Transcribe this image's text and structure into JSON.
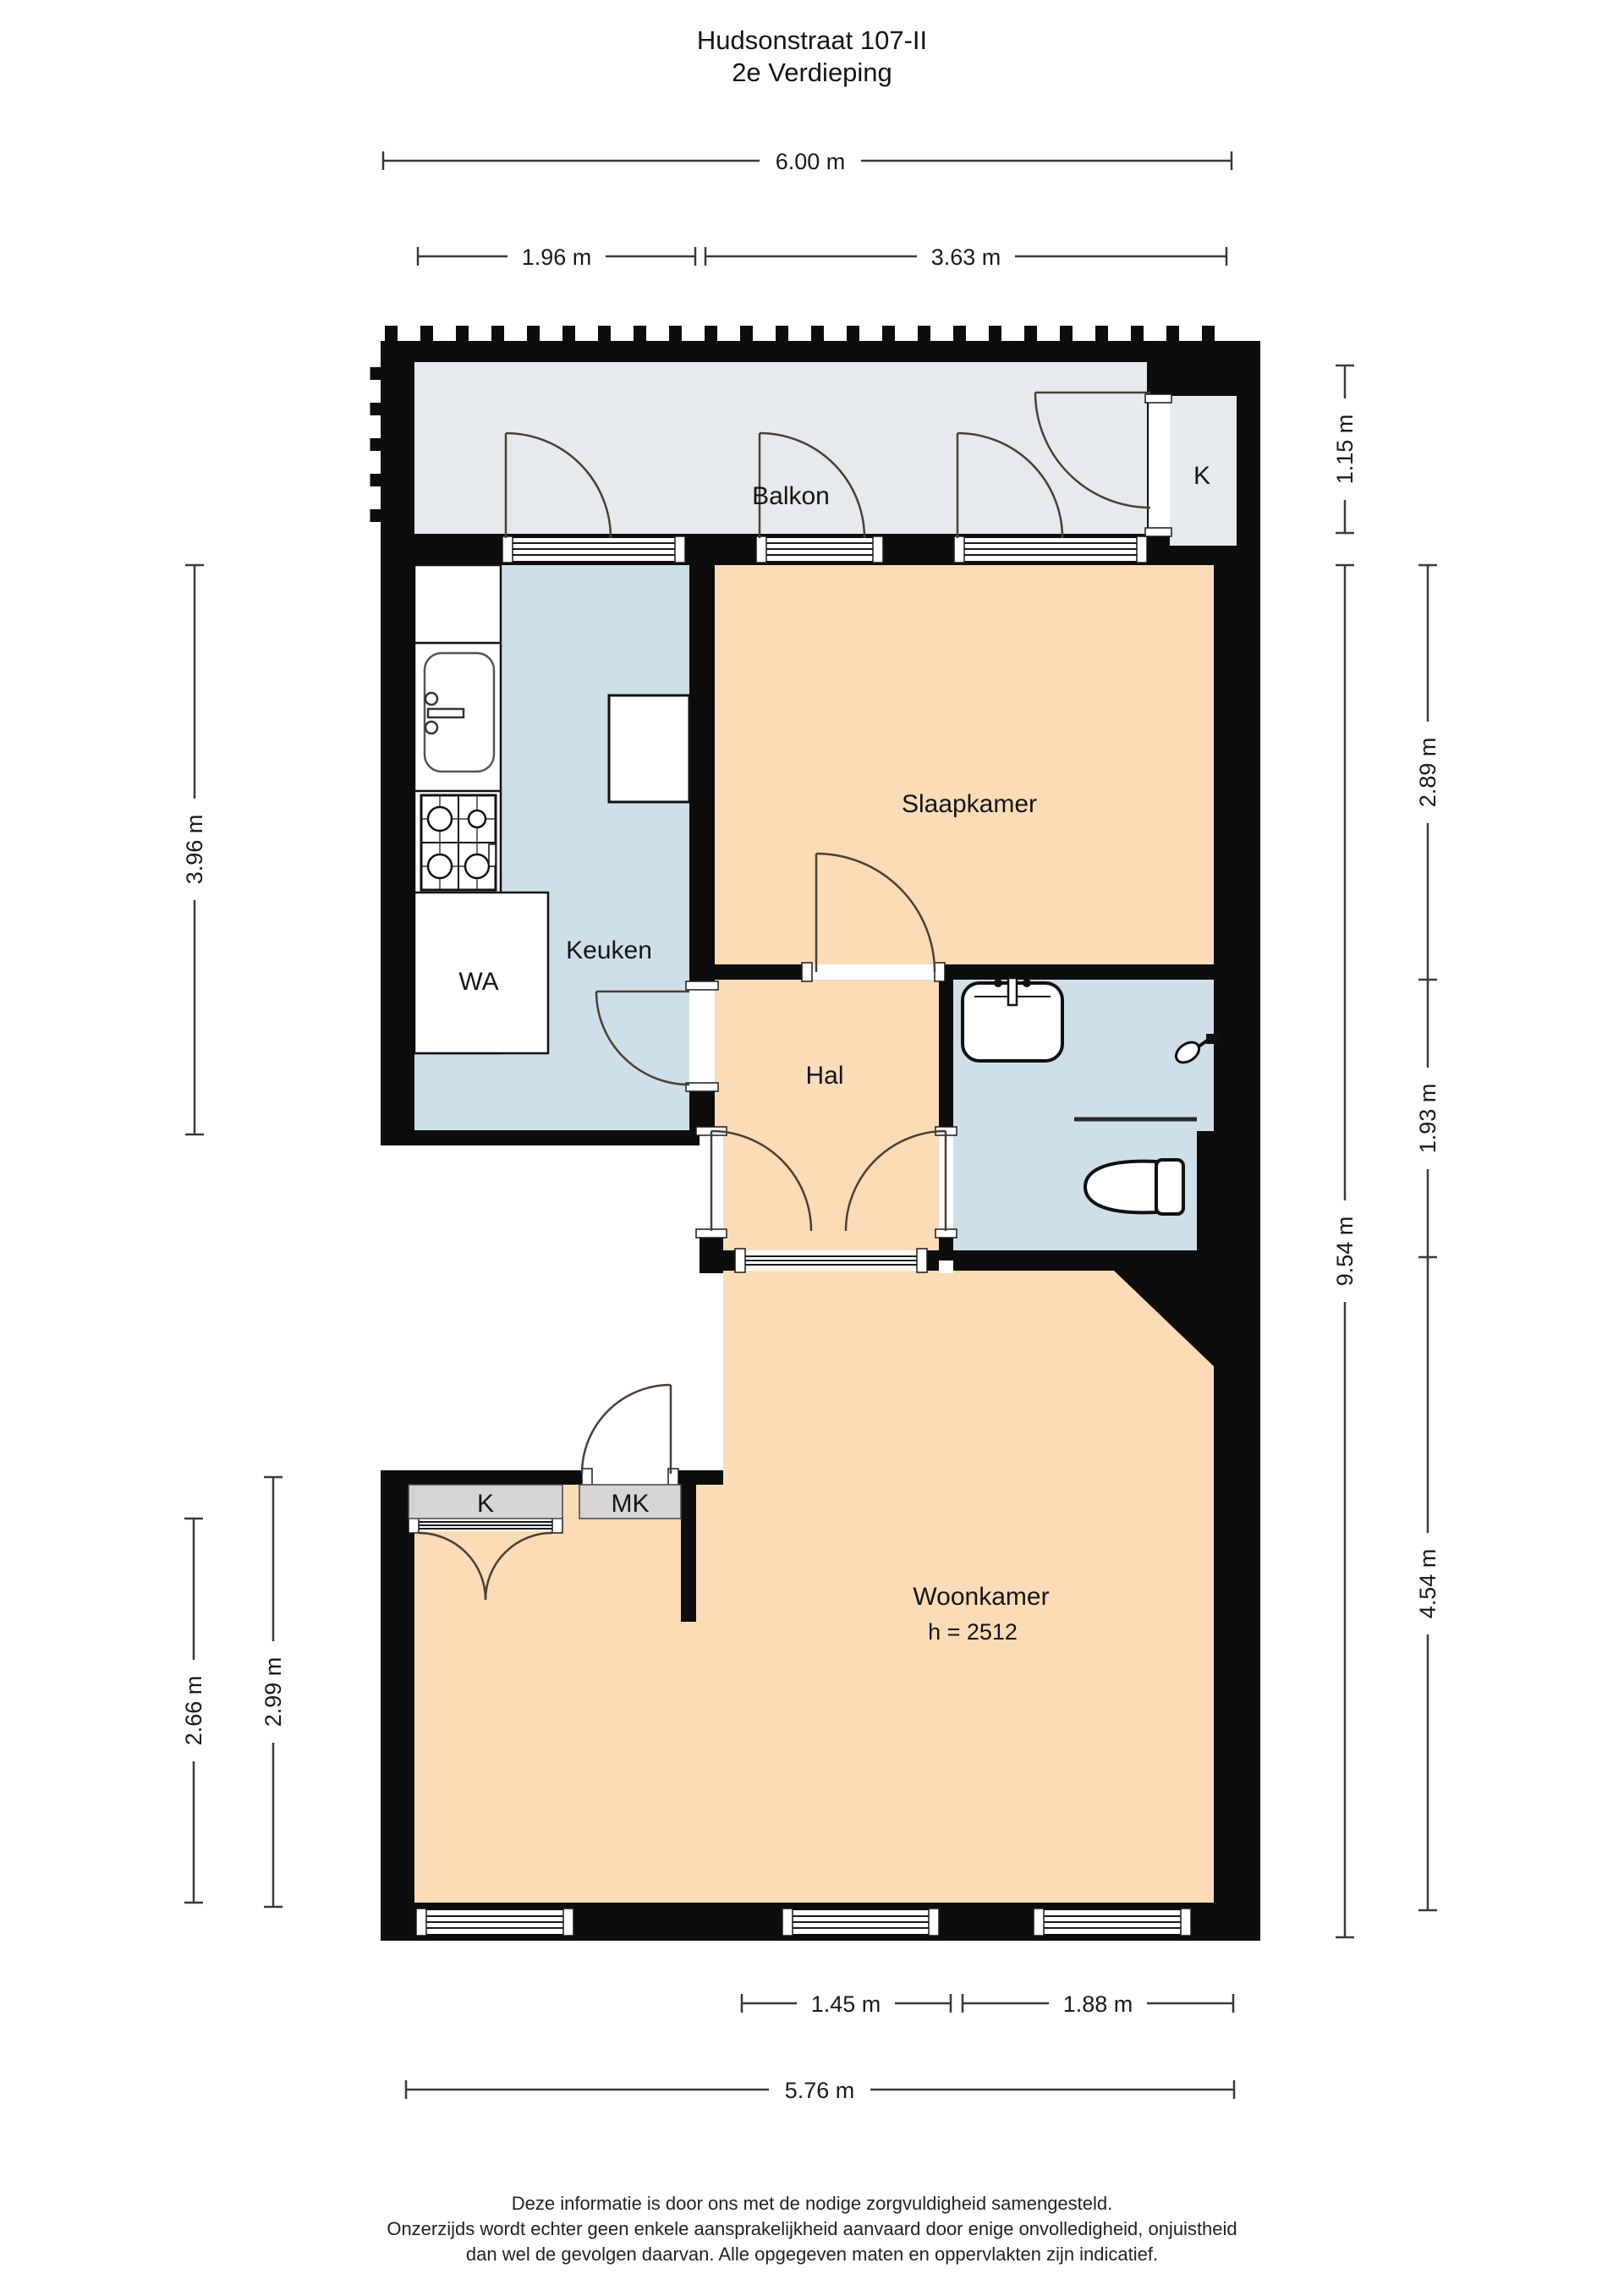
{
  "page": {
    "title_line1": "Hudsonstraat 107-II",
    "title_line2": "2e Verdieping"
  },
  "rooms": {
    "balkon": "Balkon",
    "closet_top": "K",
    "slaapkamer": "Slaapkamer",
    "keuken": "Keuken",
    "washer": "WA",
    "hal": "Hal",
    "closet_left": "K",
    "meter_closet": "MK",
    "woonkamer": "Woonkamer",
    "woonkamer_ceiling": "h = 2512"
  },
  "dimensions": {
    "top_total": "6.00 m",
    "top_left": "1.96 m",
    "top_right": "3.63 m",
    "left_kitchen": "3.96 m",
    "left_outer": "2.66 m",
    "left_inner": "2.99 m",
    "right_balcony": "1.15 m",
    "right_total": "9.54 m",
    "right_bedroom": "2.89 m",
    "right_bathroom": "1.93 m",
    "right_living": "4.54 m",
    "bottom_left": "1.45 m",
    "bottom_right": "1.88 m",
    "bottom_total": "5.76 m"
  },
  "footer": {
    "line1": "Deze informatie is door ons met de nodige zorgvuldigheid samengesteld.",
    "line2": "Onzerzijds wordt echter geen enkele aansprakelijkheid aanvaard door enige onvolledigheid, onjuistheid",
    "line3": "dan wel de gevolgen daarvan. Alle opgegeven maten en oppervlakten zijn indicatief."
  },
  "colors": {
    "room_warm": "#fbdcb7",
    "room_wet": "#cfdfe9",
    "balcony": "#e7eaec",
    "closet_fill": "#d5d5d5",
    "wall": "#0d0d0d"
  }
}
